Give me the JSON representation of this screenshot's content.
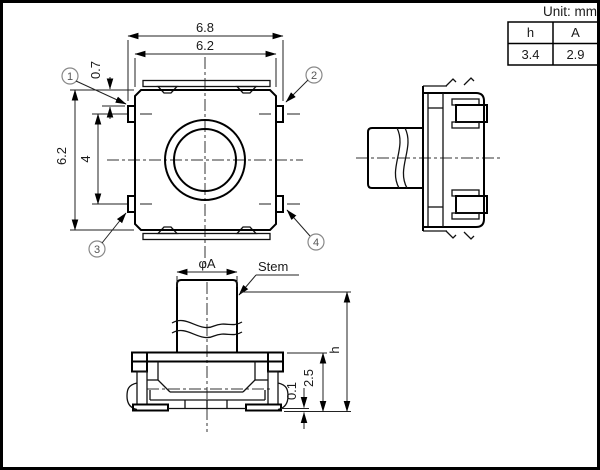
{
  "unit_label": "Unit: mm",
  "table": {
    "headers": [
      "h",
      "A"
    ],
    "values": [
      "3.4",
      "2.9"
    ]
  },
  "top_view": {
    "dim_outer_width": "6.8",
    "dim_body_width": "6.2",
    "dim_body_height": "6.2",
    "dim_terminal_pitch": "4",
    "dim_terminal_offset": "0.7",
    "terminals": [
      "1",
      "2",
      "3",
      "4"
    ]
  },
  "front_view": {
    "dim_stem_diameter": "φA",
    "stem_label": "Stem",
    "dim_total_height": "h",
    "dim_body_height": "2.5",
    "dim_standoff": "0.1"
  }
}
